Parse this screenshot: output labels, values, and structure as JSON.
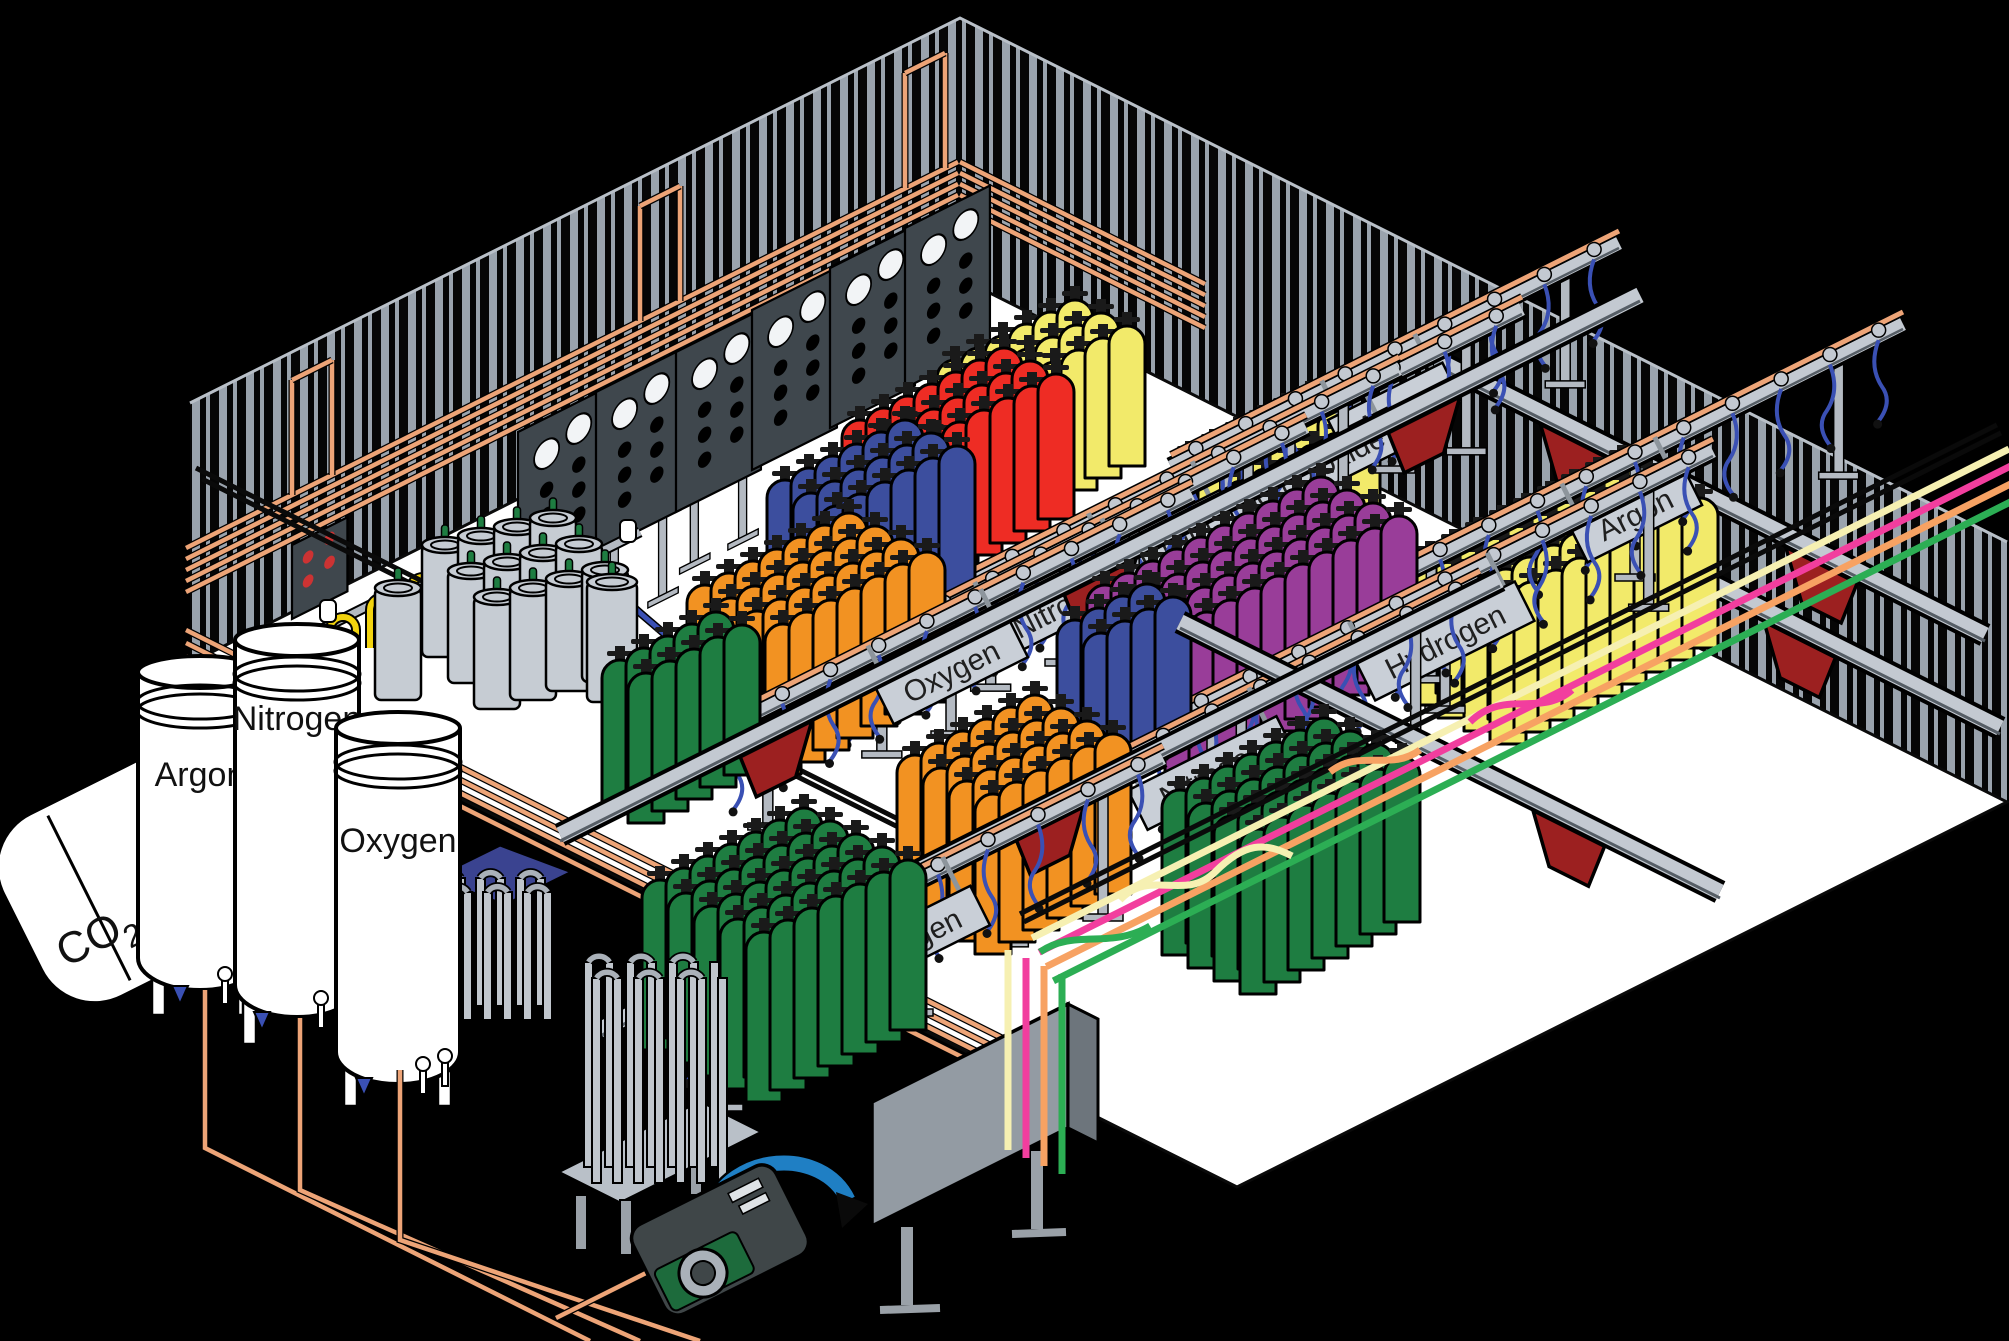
{
  "colors": {
    "background": "#000000",
    "floor": "#ffffff",
    "wall_dark": "#060606",
    "stripe": "#9aa3ad",
    "wall_edge": "#b9c0c8",
    "copper": "#eda477",
    "rail": "#c3c9d1",
    "rail_shadow": "#565e66",
    "post": "#b4bac2",
    "sign_plate": "#c9cfd7",
    "sign_text": "#1f1f1f",
    "panel_dark": "#454d53",
    "panel_face": "#3f474d",
    "gauge_white": "#f2f4f6",
    "hose_blue": "#3a50b4",
    "hose_yellow": "#f2d30e",
    "pan_red": "#9c2020",
    "dewar": "#c6ccd3",
    "valve_green": "#1e7d41",
    "tube_cream": "#f6f0b2",
    "tube_pink": "#f23e9e",
    "tube_orange": "#f7a263",
    "tube_green": "#2cae54",
    "black_rail": "#0a0a0a",
    "tank_white": "#ffffff",
    "pump_blue": "#1f7fc4",
    "pump_green": "#1d6b3c",
    "pump_dark": "#3f4648",
    "vapor_blue": "#3a4390",
    "cyl_green": "#1e7d41",
    "cyl_orange": "#f29222",
    "cyl_blue": "#3c4e9e",
    "cyl_red": "#ee2c24",
    "cyl_yellow": "#f2ea6a",
    "cyl_purple": "#993d99"
  },
  "tanks": {
    "co2_main": "CO",
    "co2_sub": "2",
    "argon": "Argon",
    "nitrogen": "Nitrogen",
    "oxygen": "Oxygen"
  },
  "stations": [
    {
      "kind": "conveyor",
      "name": "overhead-rail-right-1",
      "x1": 1440,
      "y1": 362,
      "x2": 1985,
      "y2": 635,
      "pans": [
        0.25,
        0.7
      ]
    },
    {
      "kind": "conveyor",
      "name": "overhead-rail-right-2",
      "x1": 1555,
      "y1": 505,
      "x2": 2000,
      "y2": 728,
      "pans": [
        0.55
      ]
    },
    {
      "kind": "group",
      "name": "argon-top-cylinders",
      "color": "cyl_yellow",
      "x": 1190,
      "y": 455,
      "cols": 6,
      "rows": 3,
      "h": 140
    },
    {
      "kind": "rail",
      "name": "argon-top-rail",
      "x1": 1171,
      "y1": 467,
      "x2": 1619,
      "y2": 243,
      "post": 115,
      "sign": {
        "label": "Argon",
        "len": 128
      }
    },
    {
      "kind": "group",
      "name": "carbon-dioxide-cylinders",
      "color": "cyl_yellow",
      "x": 955,
      "y": 360,
      "cols": 6,
      "rows": 3,
      "h": 140
    },
    {
      "kind": "rail",
      "name": "carbon-dioxide-rail",
      "x1": 1058,
      "y1": 541,
      "x2": 1522,
      "y2": 309,
      "post": 115,
      "sign": {
        "label": "Carbon Dioxide",
        "len": 238
      }
    },
    {
      "kind": "group",
      "name": "helium-cylinders",
      "color": "cyl_red",
      "x": 860,
      "y": 420,
      "cols": 7,
      "rows": 3,
      "h": 145
    },
    {
      "kind": "rail",
      "name": "helium-rail",
      "x1": 935,
      "y1": 601,
      "x2": 1399,
      "y2": 369,
      "post": 115,
      "sign": {
        "label": "Helium",
        "len": 140
      }
    },
    {
      "kind": "group",
      "name": "nitrogen-upper-cylinders",
      "color": "cyl_blue",
      "x": 785,
      "y": 480,
      "cols": 6,
      "rows": 3,
      "h": 148
    },
    {
      "kind": "rail",
      "name": "nitrogen-upper-rail",
      "x1": 824,
      "y1": 669,
      "x2": 1306,
      "y2": 427,
      "post": 115,
      "sign": {
        "label": "Nitrogen",
        "len": 166
      }
    },
    {
      "kind": "group",
      "name": "orange-mid-cylinders",
      "color": "cyl_orange",
      "x": 705,
      "y": 585,
      "cols": 7,
      "rows": 4,
      "h": 150
    },
    {
      "kind": "rail",
      "name": "oxygen-upper-rail",
      "x1": 710,
      "y1": 736,
      "x2": 1192,
      "y2": 494,
      "post": 120,
      "sign": {
        "label": "Oxygen",
        "len": 150
      }
    },
    {
      "kind": "group",
      "name": "green-upper-cylinders",
      "color": "cyl_green",
      "x": 620,
      "y": 660,
      "cols": 5,
      "rows": 2,
      "h": 150
    },
    {
      "kind": "conveyor",
      "name": "overhead-rail-cross-1",
      "x1": 560,
      "y1": 835,
      "x2": 1640,
      "y2": 295,
      "pans": [
        0.2,
        0.5,
        0.8
      ]
    },
    {
      "kind": "group",
      "name": "argon-right-cylinders",
      "color": "cyl_yellow",
      "x": 1430,
      "y": 555,
      "cols": 9,
      "rows": 4,
      "h": 150
    },
    {
      "kind": "rail",
      "name": "argon-right-rail",
      "x1": 1367,
      "y1": 592,
      "x2": 1903,
      "y2": 324,
      "post": 120,
      "sign": {
        "label": "Argon",
        "len": 128
      }
    },
    {
      "kind": "group",
      "name": "hydrogen-cylinders",
      "color": "cyl_purple",
      "x": 1105,
      "y": 585,
      "cols": 10,
      "rows": 4,
      "h": 155
    },
    {
      "kind": "rail",
      "name": "hydrogen-rail",
      "x1": 1177,
      "y1": 719,
      "x2": 1713,
      "y2": 451,
      "post": 125,
      "sign": {
        "label": "Hydrogen",
        "len": 178
      }
    },
    {
      "kind": "group",
      "name": "nitrogen-lower-cylinders",
      "color": "cyl_blue",
      "x": 1075,
      "y": 620,
      "cols": 4,
      "rows": 2,
      "h": 150
    },
    {
      "kind": "rail",
      "name": "nitrogen-lower-rail",
      "x1": 944,
      "y1": 851,
      "x2": 1480,
      "y2": 583,
      "post": 125,
      "sign": {
        "label": "Nitrogen",
        "len": 166
      }
    },
    {
      "kind": "group",
      "name": "orange-lower-cylinders",
      "color": "cyl_orange",
      "x": 915,
      "y": 755,
      "cols": 6,
      "rows": 4,
      "h": 160
    },
    {
      "kind": "conveyor",
      "name": "overhead-rail-right-3",
      "x1": 1180,
      "y1": 622,
      "x2": 1720,
      "y2": 892,
      "pans": [
        0.72
      ]
    },
    {
      "kind": "conveyor",
      "name": "overhead-rail-cross-2",
      "x1": 600,
      "y1": 1030,
      "x2": 1500,
      "y2": 580,
      "pans": [
        0.18,
        0.5
      ]
    },
    {
      "kind": "group",
      "name": "green-right-cylinders",
      "color": "cyl_green",
      "x": 1180,
      "y": 790,
      "cols": 7,
      "rows": 4,
      "h": 165
    },
    {
      "kind": "rail",
      "name": "oxygen-lower-rail",
      "x1": 663,
      "y1": 1008,
      "x2": 1163,
      "y2": 758,
      "post": 130,
      "sign": {
        "label": "Oxygen",
        "len": 150
      }
    },
    {
      "kind": "group",
      "name": "green-front-cylinders",
      "color": "cyl_green",
      "x": 660,
      "y": 880,
      "cols": 7,
      "rows": 5,
      "h": 170
    }
  ],
  "wall_panels": [
    {
      "x": 518,
      "y": 432,
      "legs": 95
    },
    {
      "x": 596,
      "y": 392,
      "legs": 80
    },
    {
      "x": 676,
      "y": 352,
      "legs": 62
    },
    {
      "x": 752,
      "y": 310,
      "legs": 0
    },
    {
      "x": 830,
      "y": 268,
      "legs": 0
    },
    {
      "x": 905,
      "y": 228,
      "legs": 0
    }
  ],
  "dewars": [
    {
      "x": 445,
      "y": 545,
      "cols": 4,
      "rows": 3,
      "colStep": [
        36,
        -9
      ],
      "rowStep": [
        26,
        26
      ],
      "w": 46,
      "h": 112
    },
    {
      "x": 398,
      "y": 588,
      "cols": 1,
      "rows": 1,
      "colStep": [
        36,
        -9
      ],
      "rowStep": [
        26,
        26
      ],
      "w": 46,
      "h": 112
    },
    {
      "x": 612,
      "y": 582,
      "cols": 1,
      "rows": 1,
      "colStep": [
        36,
        -9
      ],
      "rowStep": [
        26,
        26
      ],
      "w": 50,
      "h": 120
    }
  ],
  "vaporizers": [
    {
      "target": "vaporizer-1",
      "x": 436,
      "y": 878,
      "cols": 6,
      "slatW": 9,
      "gap": 11,
      "h": 128,
      "rows": [
        [
          0,
          0
        ],
        [
          7,
          14
        ]
      ]
    },
    {
      "target": "vaporizer-2",
      "x": 584,
      "y": 962,
      "cols": 7,
      "slatW": 9,
      "gap": 12,
      "h": 205,
      "rows": [
        [
          0,
          0
        ],
        [
          8,
          16
        ]
      ]
    }
  ],
  "band": {
    "x": 1032,
    "y": 938,
    "dx": 977,
    "dy": -489,
    "gap": 16,
    "keys": [
      "tube_cream",
      "tube_pink",
      "tube_orange",
      "tube_green"
    ],
    "black_offsets": [
      -18,
      -27
    ]
  },
  "tubes_vertical": [
    {
      "x": 1008,
      "y1": 950,
      "y2": 1150,
      "key": "tube_cream"
    },
    {
      "x": 1026,
      "y1": 958,
      "y2": 1158,
      "key": "tube_pink"
    },
    {
      "x": 1044,
      "y1": 966,
      "y2": 1166,
      "key": "tube_orange"
    },
    {
      "x": 1062,
      "y1": 974,
      "y2": 1174,
      "key": "tube_green"
    }
  ]
}
